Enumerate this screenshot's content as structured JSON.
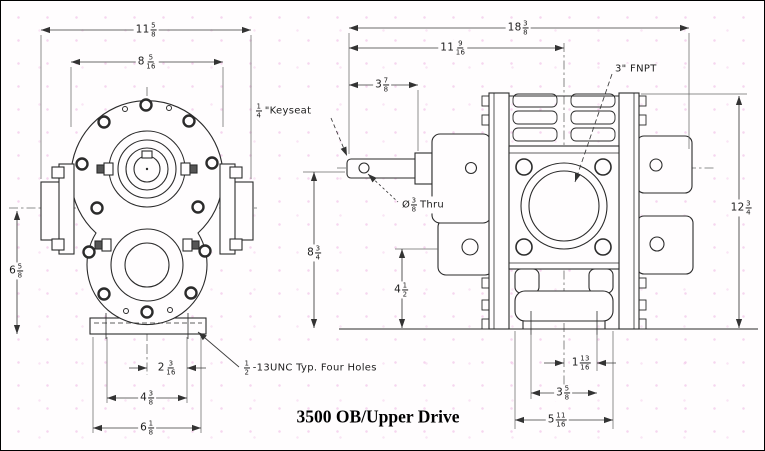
{
  "title": "3500 OB/Upper Drive",
  "front_view": {
    "dim_overall_width": {
      "whole": "11",
      "num": "5",
      "den": "8"
    },
    "dim_bolt_flange_width": {
      "whole": "8",
      "num": "5",
      "den": "16"
    },
    "dim_port_center_height": {
      "whole": "6",
      "num": "5",
      "den": "8"
    },
    "dim_hole_to_centerline": {
      "whole": "2",
      "num": "3",
      "den": "16"
    },
    "dim_hole_spacing": {
      "whole": "4",
      "num": "3",
      "den": "8"
    },
    "dim_base_width": {
      "whole": "6",
      "num": "1",
      "den": "8"
    },
    "note_mounting_holes": {
      "num": "1",
      "den": "2",
      "text": "-13UNC Typ. Four Holes"
    }
  },
  "side_view": {
    "dim_overall_length": {
      "whole": "18",
      "num": "3",
      "den": "8"
    },
    "dim_shaft_end_to_port_center": {
      "whole": "11",
      "num": "9",
      "den": "16"
    },
    "dim_shaft_length": {
      "whole": "3",
      "num": "7",
      "den": "8"
    },
    "label_keyseat": {
      "num": "1",
      "den": "4",
      "text": "\"Keyseat"
    },
    "label_shaft_hole": {
      "prefix": "Ø",
      "num": "3",
      "den": "8",
      "text": "Thru"
    },
    "label_port": "3\" FNPT",
    "dim_shaft_center_height": {
      "whole": "8",
      "num": "3",
      "den": "4"
    },
    "dim_bracket_hole_height": {
      "whole": "4",
      "num": "1",
      "den": "2"
    },
    "dim_overall_height": {
      "whole": "12",
      "num": "3",
      "den": "4"
    },
    "dim_foot_hole_to_centerline": {
      "whole": "1",
      "num": "13",
      "den": "16"
    },
    "dim_foot_hole_spacing": {
      "whole": "3",
      "num": "5",
      "den": "8"
    },
    "dim_foot_width": {
      "whole": "5",
      "num": "11",
      "den": "16"
    }
  }
}
